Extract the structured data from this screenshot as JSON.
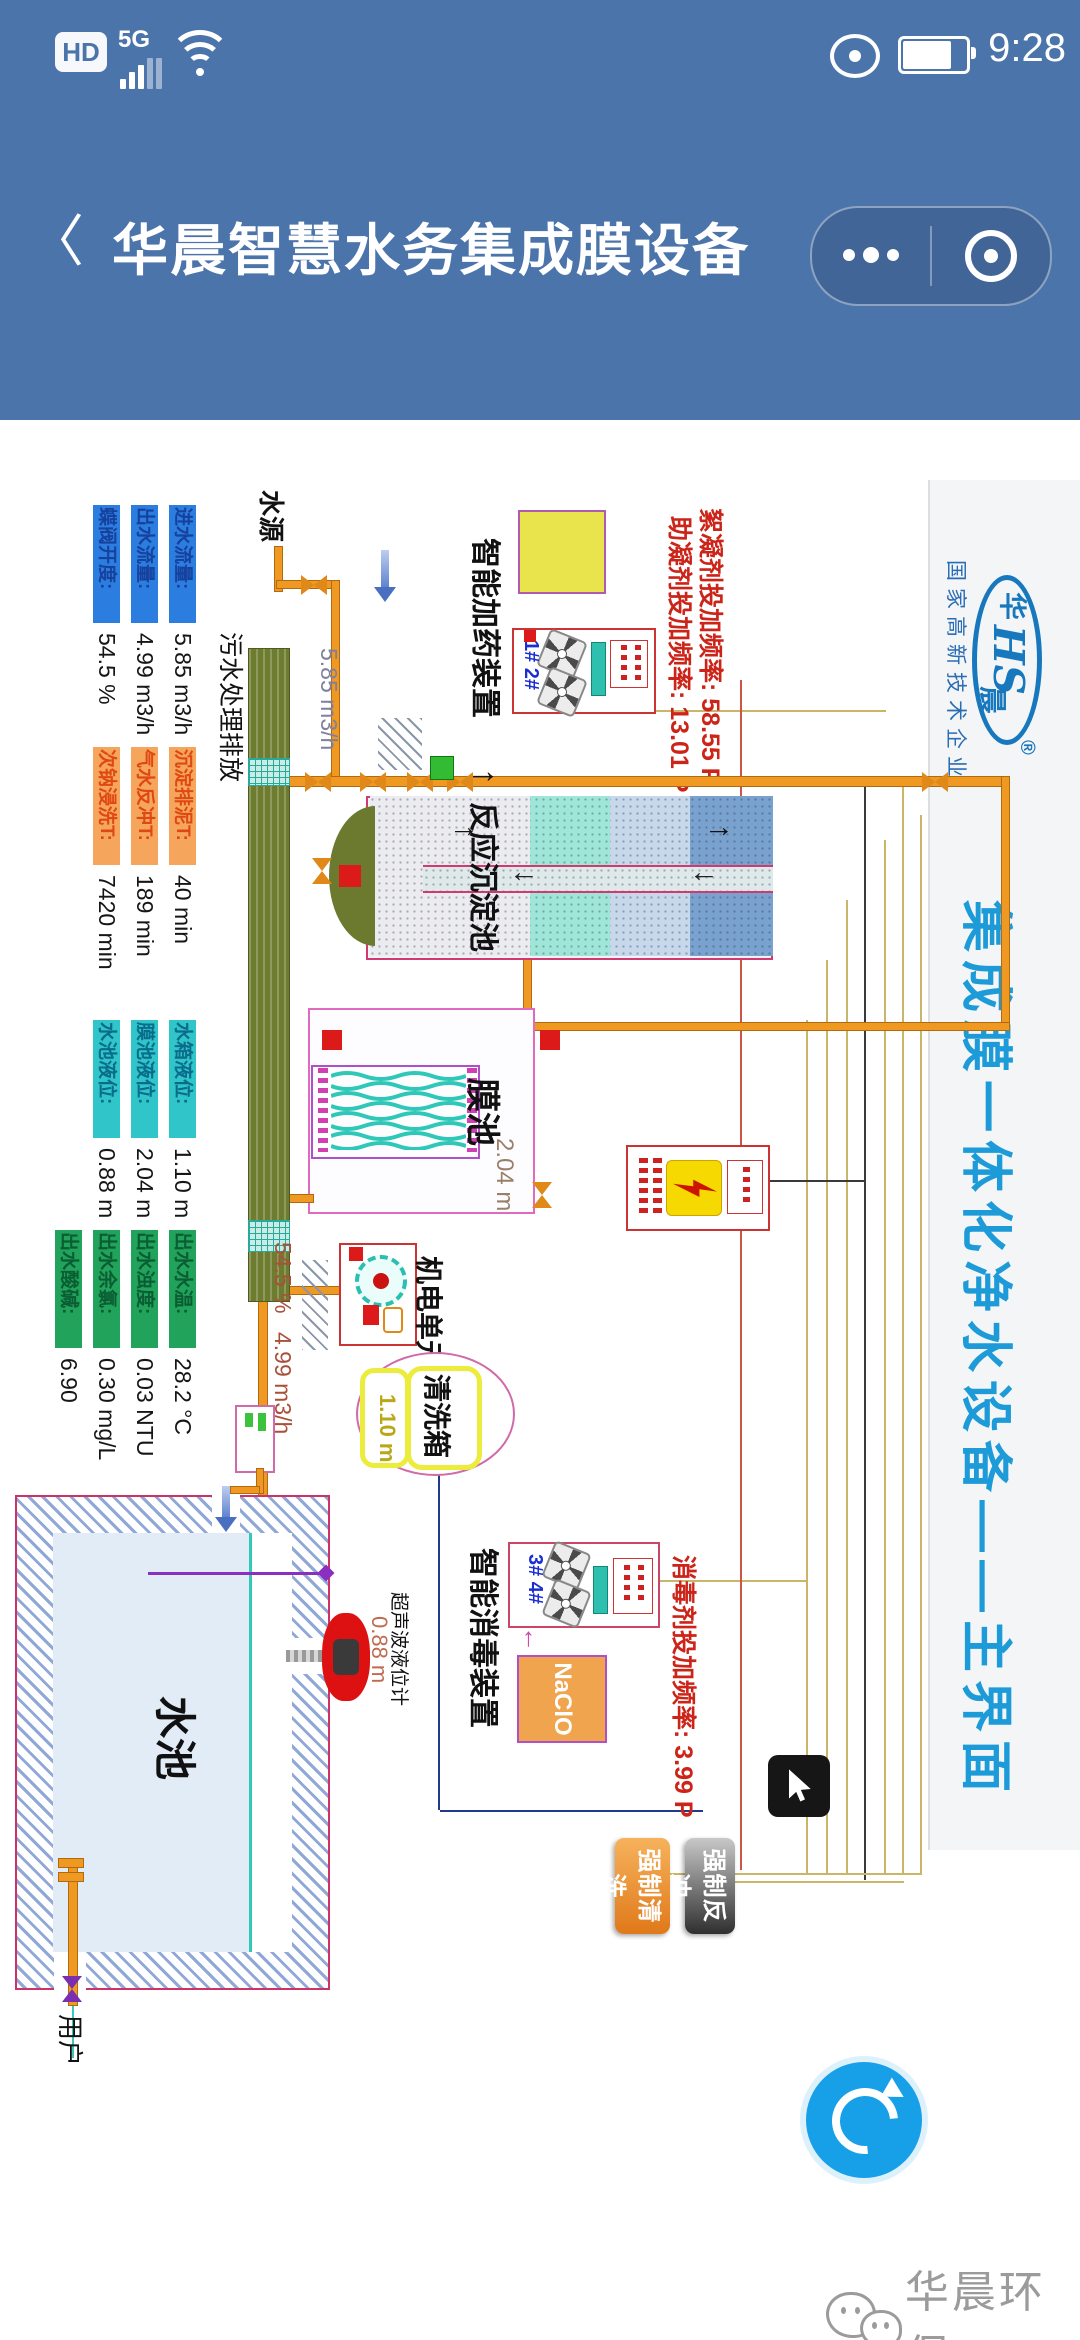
{
  "status_bar": {
    "hd": "HD",
    "network": "5G",
    "time": "9:28"
  },
  "nav": {
    "back_icon": "〈",
    "title": "华晨智慧水务集成膜设备"
  },
  "banner": {
    "logo_monogram": "HS",
    "logo_char_1": "华",
    "logo_char_2": "晨",
    "registered_mark": "®",
    "cert_text": "国家高新技术企业",
    "title": "集成膜一体化净水设备——主界面"
  },
  "scada": {
    "labels": {
      "water_source": "水源",
      "sewage_discharge": "污水处理排放",
      "dosing_device": "智能加药装置",
      "reaction_tank": "反应沉淀池",
      "membrane_tank": "膜池",
      "membrane_level": "2.04 m",
      "electro_unit": "机电单元",
      "cleaning_box": "清洗箱",
      "cleaning_level": "1.10 m",
      "disinfection_device": "智能消毒装置",
      "naclo": "NaClO",
      "pool": "水池",
      "level_sensor": "超声波液位计",
      "pool_level": "0.88 m",
      "user": "用户",
      "pump_ids_dosing": "1# 2#",
      "pump_ids_disinfect": "3# 4#",
      "inlet_flow_pipe": "5.85 m3/h",
      "valve_open_pipe": "54.5 %",
      "outlet_flow_pipe": "4.99 m3/h"
    },
    "frequency_texts": {
      "flocculant": "絮凝剂投加频率: 58.55 P",
      "coagulant_aid": "助凝剂投加频率: 13.01 P",
      "disinfectant": "消毒剂投加频率: 3.99 P"
    },
    "buttons": {
      "force_clean": "强制清洗",
      "force_backwash": "强制反冲"
    },
    "metrics": {
      "blue": {
        "strip_bg": "#2b7de0",
        "strip_text": "#16419c",
        "items": [
          {
            "label": "进水流量:",
            "value": "5.85 m3/h"
          },
          {
            "label": "出水流量:",
            "value": "4.99 m3/h"
          },
          {
            "label": "蝶阀开度:",
            "value": "54.5 %"
          }
        ]
      },
      "orange": {
        "strip_bg": "#f6a55c",
        "strip_text": "#e04812",
        "items": [
          {
            "label": "沉淀排泥T:",
            "value": "40 min"
          },
          {
            "label": "气水反冲T:",
            "value": "189 min"
          },
          {
            "label": "次钠浸洗T:",
            "value": "7420 min"
          }
        ]
      },
      "teal": {
        "strip_bg": "#30c5c9",
        "strip_text": "#0a6b8a",
        "items": [
          {
            "label": "水箱液位:",
            "value": "1.10 m"
          },
          {
            "label": "膜池液位:",
            "value": "2.04 m"
          },
          {
            "label": "水池液位:",
            "value": "0.88 m"
          }
        ]
      },
      "green": {
        "strip_bg": "#21a35b",
        "strip_text": "#0a5c32",
        "items": [
          {
            "label": "出水水温:",
            "value": "28.2 °C"
          },
          {
            "label": "出水浊度:",
            "value": "0.03 NTU"
          },
          {
            "label": "出水余氯:",
            "value": "0.30 mg/L"
          },
          {
            "label": "出水酸碱:",
            "value": "6.90"
          }
        ]
      }
    }
  },
  "watermark": "华晨环保",
  "colors": {
    "header_blue": "#4b74ab",
    "banner_title_blue": "#1d9bd8",
    "logo_blue": "#1878be",
    "refresh_blue": "#17a0e8",
    "alarm_red_text": "#cc2418",
    "pipe_orange": "#ef9822",
    "pool_water": "#e2ecf6"
  }
}
